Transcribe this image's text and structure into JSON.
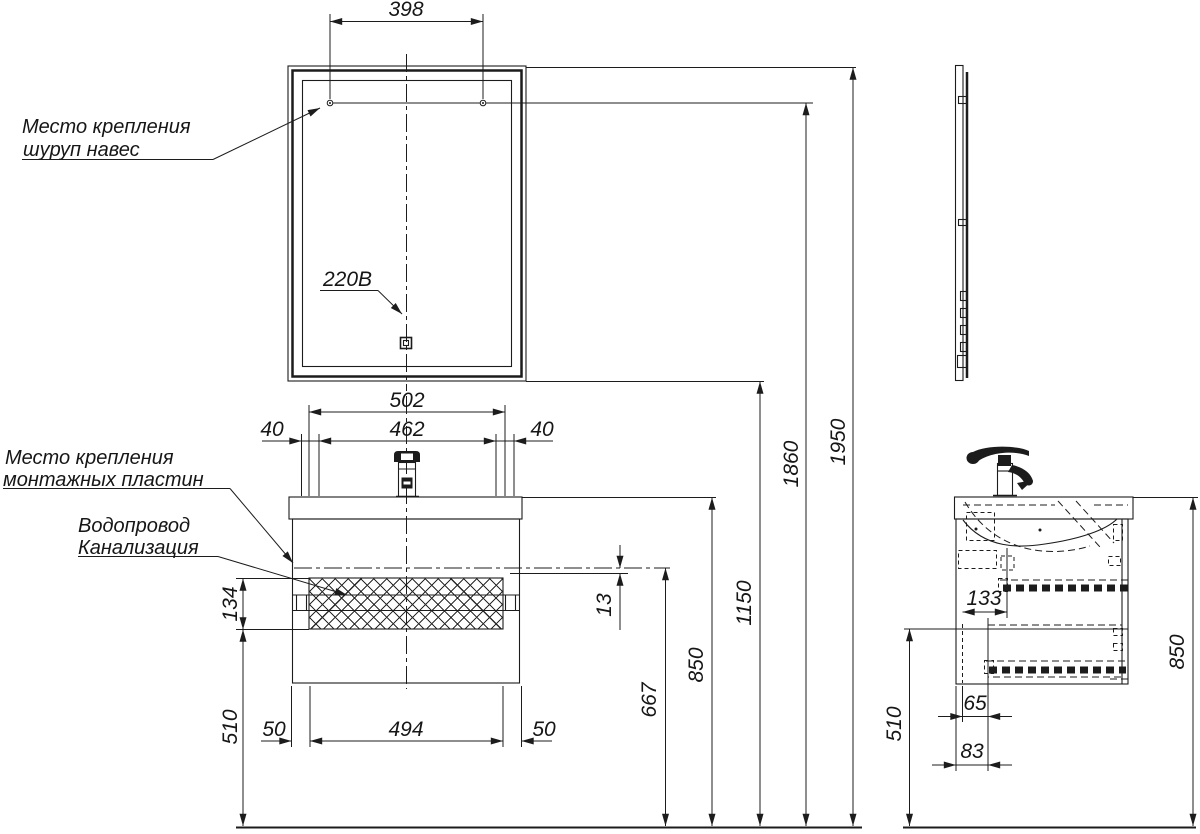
{
  "labels": {
    "mirror_mount_line1": "Место крепления",
    "mirror_mount_line2": "шуруп навес",
    "plates_line1": "Место крепления",
    "plates_line2": "монтажных пластин",
    "plumbing_line1": "Водопровод",
    "plumbing_line2": "Канализация",
    "power": "220В"
  },
  "dims": {
    "d398": "398",
    "d502": "502",
    "d462": "462",
    "d40l": "40",
    "d40r": "40",
    "d134": "134",
    "d510_front": "510",
    "d50l": "50",
    "d494": "494",
    "d50r": "50",
    "d13": "13",
    "d667": "667",
    "d850_front": "850",
    "d1150": "1150",
    "d1860": "1860",
    "d1950": "1950",
    "d133": "133",
    "d65": "65",
    "d83": "83",
    "d510_side": "510",
    "d850_side": "850"
  }
}
